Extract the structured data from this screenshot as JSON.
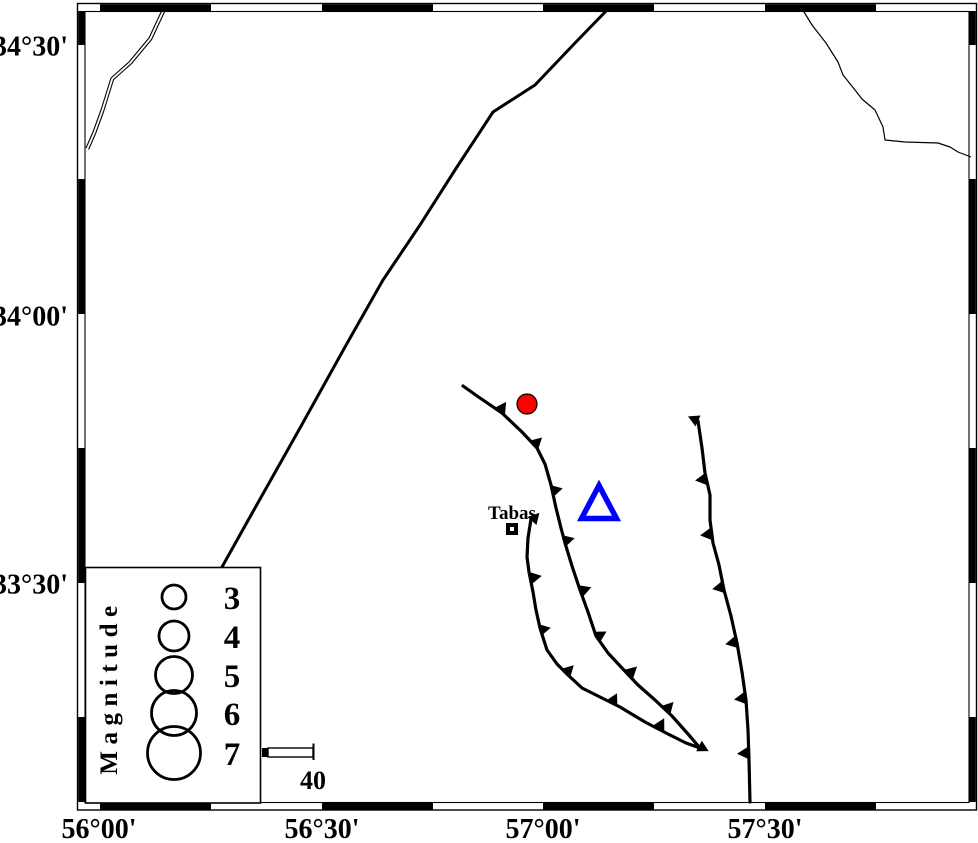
{
  "title": "Tabas region seismotectonic map",
  "colors": {
    "line": "#000000",
    "epicenter_fill": "#ff0000",
    "station_stroke": "#0000ff",
    "background": "#ffffff"
  },
  "frame": {
    "outer": {
      "x1": 77.5,
      "y1": 3.5,
      "x2": 976.5,
      "y2": 810
    },
    "inner": {
      "x1": 85,
      "y1": 11.5,
      "x2": 969,
      "y2": 802.5
    },
    "h_black_segments": [
      [
        100,
        211
      ],
      [
        322,
        433
      ],
      [
        543,
        654
      ],
      [
        765,
        876
      ]
    ],
    "v_black_segments": [
      [
        11,
        45
      ],
      [
        179,
        314
      ],
      [
        448,
        583
      ],
      [
        717,
        802
      ]
    ]
  },
  "axis": {
    "lat_labels": [
      {
        "text": "34°30'",
        "y": 45
      },
      {
        "text": "34°00'",
        "y": 315
      },
      {
        "text": "33°30'",
        "y": 583
      }
    ],
    "lon_labels": [
      {
        "text": "56°00'",
        "x": 99
      },
      {
        "text": "56°30'",
        "x": 322
      },
      {
        "text": "57°00'",
        "x": 543
      },
      {
        "text": "57°30'",
        "x": 765
      }
    ]
  },
  "boundary_line": {
    "name": "mountain-front-line",
    "points": "610,7 575,43 535,85 493,112 455,170 420,225 383,280 345,347 300,428 255,508 222,567",
    "width": 3
  },
  "rivers": [
    {
      "name": "river-northeast",
      "points": "801,7 812,25 826,43 838,62 843,75 855,90 862,99 875,110 883,127 885,140 905,142 938,143 950,147 958,152 971,157",
      "width": 1.2
    },
    {
      "name": "river-northwest-a",
      "points": "163,8 149,38 129,62 111,78 101,110 93,132 86,148",
      "width": 1.1
    },
    {
      "name": "river-northwest-b",
      "points": "165.6,9.5 151.6,39.5 131.6,63.5 113.6,79.5 103.6,111.5 95.6,133.5 88.6,149.5",
      "width": 1.1
    }
  ],
  "faults": [
    {
      "name": "thrust-fault-west-main",
      "points": "463,386 480,398 502,413 522,432 537,448 545,464 551,485 556,508 561,528 565,543 572,566 580,590 588,612 596,636 608,653 622,668 638,685 655,700 672,716 688,734 700,748",
      "width": 3.2,
      "teeth": [
        [
          500,
          411,
          -56
        ],
        [
          534,
          445,
          -43
        ],
        [
          552,
          491,
          -14
        ],
        [
          564,
          541,
          -15
        ],
        [
          581,
          591,
          -20
        ],
        [
          597,
          637,
          -30
        ],
        [
          629,
          674,
          -43
        ],
        [
          666,
          710,
          -47
        ],
        [
          699,
          746,
          28
        ]
      ]
    },
    {
      "name": "thrust-fault-west-branch",
      "points": "531,519 528,538 527,557 529,572 533,592 536,610 540,628 547,650 557,664 568,675 582,688 600,697 620,707 645,722 668,734 686,743 700,748",
      "width": 3.2,
      "teeth": [
        [
          532,
          521,
          -48
        ],
        [
          531,
          578,
          -11
        ],
        [
          540,
          630,
          -12
        ],
        [
          566,
          673,
          -45
        ],
        [
          612,
          703,
          -63
        ],
        [
          659,
          728,
          -62
        ]
      ]
    },
    {
      "name": "thrust-fault-east",
      "points": "698,421 702,448 705,473 710,495 710,520 713,543 719,565 724,590 731,616 737,643 742,672 746,700 748,730 749,760 750,802",
      "width": 3.2,
      "teeth": [
        [
          698,
          421,
          -155
        ],
        [
          706,
          479,
          172
        ],
        [
          711,
          534,
          173
        ],
        [
          723,
          587,
          169
        ],
        [
          736,
          642,
          168
        ],
        [
          745,
          698,
          172
        ],
        [
          748,
          753,
          176
        ]
      ]
    }
  ],
  "markers": {
    "epicenter": {
      "x": 527,
      "y": 404,
      "r": 10,
      "stroke_width": 1.2
    },
    "station": {
      "x": 599,
      "y": 502,
      "half_width": 17.5,
      "height": 33,
      "stroke_width": 5.5
    },
    "city": {
      "name": "Tabas",
      "square": {
        "x": 506,
        "y": 523,
        "size": 12,
        "inner_size": 4
      },
      "label_x": 512,
      "label_y": 519
    }
  },
  "legend": {
    "title": "Magnitude",
    "box": {
      "x": 85.5,
      "y": 567.5,
      "w": 175,
      "h": 235.5
    },
    "title_x": 117,
    "title_y": 687,
    "circle_cx": 174,
    "circle_stroke": 2.8,
    "label_cx": 232,
    "entries": [
      {
        "label": "3",
        "cy": 597,
        "r": 12
      },
      {
        "label": "4",
        "cy": 636,
        "r": 15
      },
      {
        "label": "5",
        "cy": 675,
        "r": 18.5
      },
      {
        "label": "6",
        "cy": 713,
        "r": 22.5
      },
      {
        "label": "7",
        "cy": 753,
        "r": 26.5
      }
    ]
  },
  "scale_bar": {
    "label": "40",
    "filled_block": {
      "x": 262,
      "y": 748,
      "w": 6,
      "h": 9
    },
    "open_block": {
      "x": 268,
      "y": 748,
      "w": 45,
      "h": 9
    },
    "end_tick": {
      "x": 313.5,
      "y1": 743.5,
      "y2": 760
    },
    "label_x": 313,
    "label_y": 789
  }
}
